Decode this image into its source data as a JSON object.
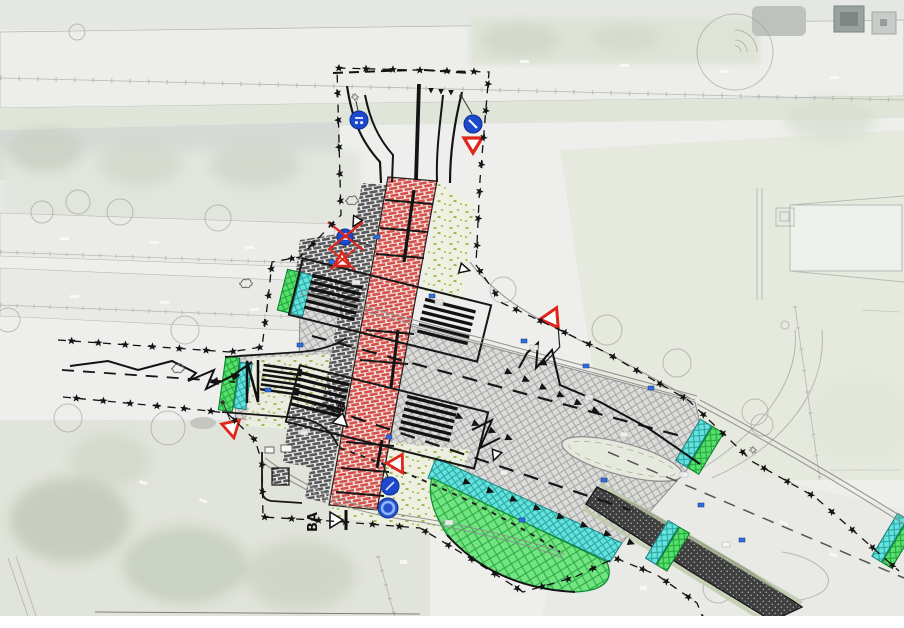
{
  "plan": {
    "title": "traffic-redesign-site-plan",
    "section_markers": {
      "primary": "BA",
      "secondary": "B"
    },
    "colors": {
      "cycle_path_red": "#d5504a",
      "cycle_path_mortar": "#f2e3df",
      "footpath_brick_gray": "#575757",
      "footpath_mortar": "#e9e9e9",
      "carriageway_hatch_line": "#9f9e9c",
      "carriageway_base": "#dbdbd9",
      "island_green": "#55e06c",
      "island_green_line": "#22a53e",
      "island_cyan": "#63e2de",
      "island_cyan_line": "#2aa49f",
      "big_island_green": "#74e381",
      "big_island_green_line": "#27aa42",
      "new_asphalt_black": "#3f3f3f",
      "new_asphalt_dot": "#bdbdbd",
      "verge_speckle_green": "#98b44c",
      "verge_base": "#edf0e1",
      "sign_blue": "#1d49cf",
      "sign_red": "#e0251b",
      "marking_black": "#141414",
      "utility_blue": "#2e6fe0"
    },
    "icons": {
      "boundary_star": "star-marker-icon",
      "yield_tooth": "shark-tooth-marking-icon",
      "give_way": "give-way-triangle-sign",
      "blue_circle": "mandatory-blue-circle-sign",
      "removed_sign": "crossed-out-sign",
      "lamp": "street-lamp-icon"
    }
  }
}
